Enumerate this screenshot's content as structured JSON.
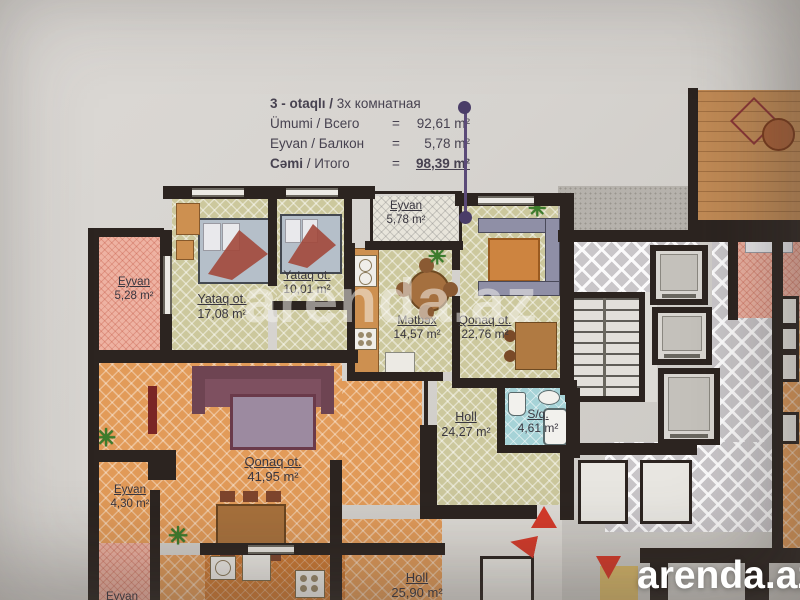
{
  "title_block": {
    "type": {
      "strong": "3 - otaqlı /",
      "rest": " 3х комнатная"
    },
    "equals": "=",
    "rows": [
      {
        "strong": "",
        "rest": "Ümumi / Всего",
        "value": "92,61 m²"
      },
      {
        "strong": "",
        "rest": "Eyvan / Балкон",
        "value": "5,78 m²"
      },
      {
        "strong": "Cəmi",
        "rest": " / Итого",
        "value": "98,39 m²"
      }
    ]
  },
  "rooms": [
    {
      "name": "Yataq ot.",
      "area": "17,08 m²"
    },
    {
      "name": "Yataq ot.",
      "area": "10,01 m²"
    },
    {
      "name": "Eyvan",
      "area": "5,78 m²"
    },
    {
      "name": "Mətbəx",
      "area": "14,57 m²"
    },
    {
      "name": "Qonaq ot.",
      "area": "22,76 m²"
    },
    {
      "name": "Holl",
      "area": "24,27 m²"
    },
    {
      "name": "S/q.",
      "area": "4,61 m²"
    },
    {
      "name": "Eyvan",
      "area": "5,28 m²"
    },
    {
      "name": "Qonaq ot.",
      "area": "41,95 m²"
    },
    {
      "name": "Eyvan",
      "area": "4,30 m²"
    },
    {
      "name": "Holl",
      "area": "25,90 m²"
    },
    {
      "name": "Eyvan",
      "area": ""
    }
  ],
  "watermark": "arenda.az",
  "logo": "arenda.az",
  "glyphs": {
    "plant": "✳"
  },
  "colors": {
    "wall": "#2c2420",
    "apartment_floor": "#ccc89d",
    "neighbor_floor": "#e29b59",
    "balcony_floor": "#eeb2a2",
    "bathroom_floor": "#a6d3d7",
    "corridor_floor": "#c9c6c9",
    "marker_red": "#d63a2a",
    "leader_purple": "#4a3d68",
    "logo_text": "#ffffff"
  }
}
